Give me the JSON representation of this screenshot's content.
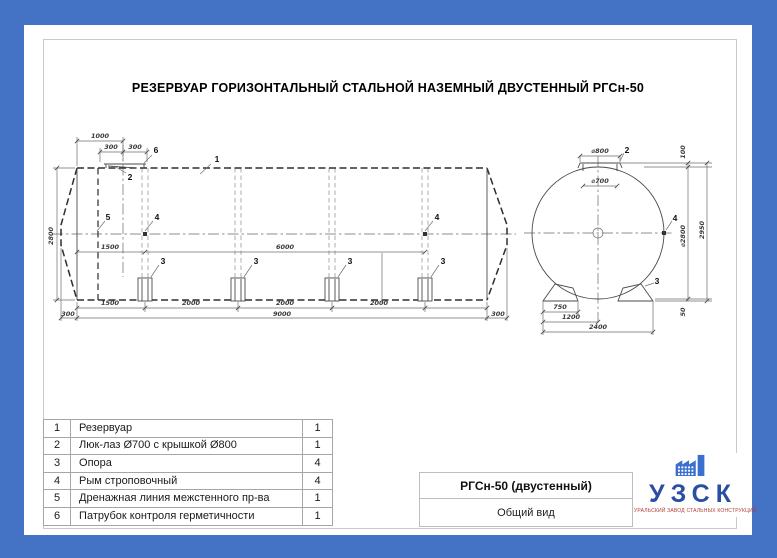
{
  "heading": "РЕЗЕРВУАР ГОРИЗОНТАЛЬНЫЙ СТАЛЬНОЙ НАЗЕМНЫЙ ДВУСТЕННЫЙ РГСн-50",
  "colors": {
    "frame": "#4472C4",
    "logo_blue": "#2a4fa2",
    "logo_icon": "#3a6ed0",
    "tagline_red": "#b03a3a"
  },
  "parts_table": {
    "rows": [
      {
        "num": "1",
        "name": "Резервуар",
        "qty": "1"
      },
      {
        "num": "2",
        "name": "Люк-лаз Ø700 с крышкой Ø800",
        "qty": "1"
      },
      {
        "num": "3",
        "name": "Опора",
        "qty": "4"
      },
      {
        "num": "4",
        "name": "Рым строповочный",
        "qty": "4"
      },
      {
        "num": "5",
        "name": "Дренажная линия межстенного пр-ва",
        "qty": "1"
      },
      {
        "num": "6",
        "name": "Патрубок контроля герметичности",
        "qty": "1"
      }
    ]
  },
  "title_block": {
    "model": "РГСн-50 (двустенный)",
    "view": "Общий вид"
  },
  "logo": {
    "abbr": "УЗСК",
    "tagline": "УРАЛЬСКИЙ ЗАВОД СТАЛЬНЫХ КОНСТРУКЦИЙ",
    "icon": "factory-icon"
  },
  "drawing": {
    "side_labels": [
      "1000",
      "300",
      "300",
      "2800",
      "1500",
      "6000",
      "1500",
      "2000",
      "2000",
      "2000",
      "9000",
      "300",
      "300"
    ],
    "side_callouts": [
      "1",
      "6",
      "2",
      "5",
      "4",
      "4",
      "3",
      "3",
      "3",
      "3"
    ],
    "end_labels": [
      "⌀800",
      "⌀700",
      "100",
      "⌀2800",
      "2950",
      "50",
      "750",
      "1200",
      "2400"
    ],
    "end_callouts": [
      "2",
      "4",
      "3"
    ]
  }
}
